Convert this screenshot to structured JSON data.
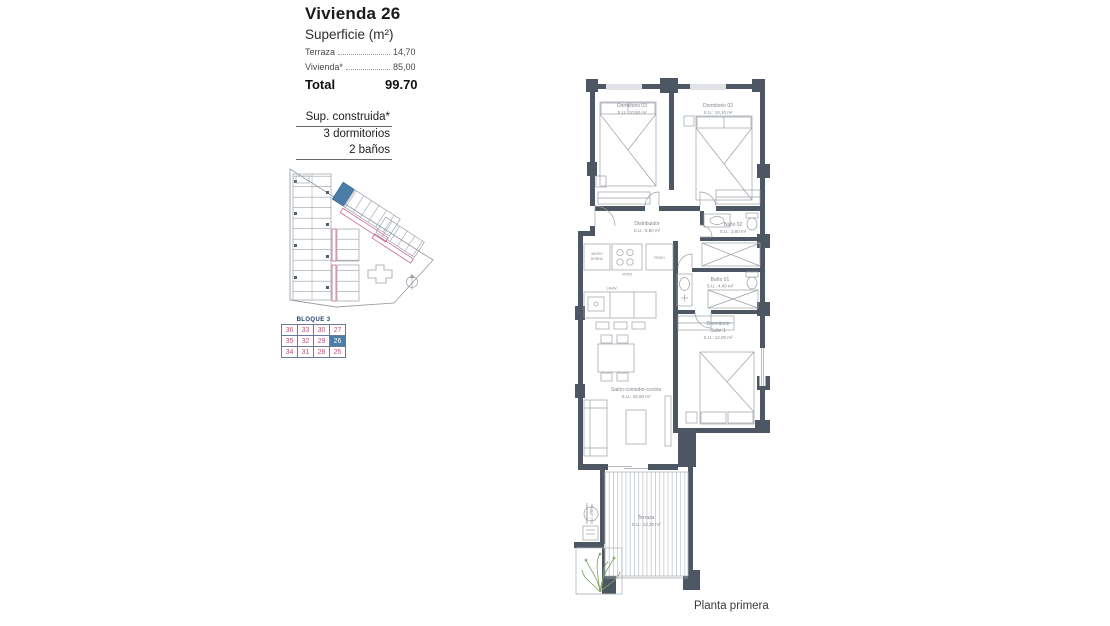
{
  "title_block": {
    "title": "Vivienda 26",
    "subtitle": "Superficie (m²)",
    "rows": [
      {
        "label": "Terraza",
        "value": "14,70"
      },
      {
        "label": "Vivienda*",
        "value": "85,00"
      }
    ],
    "total_label": "Total",
    "total_value": "99.70"
  },
  "summary": {
    "lines": [
      "Sup. construida*",
      "3 dormitorios",
      "2 baños"
    ]
  },
  "block_table": {
    "header": "BLOQUE 3",
    "rows": [
      [
        "36",
        "33",
        "30",
        "27"
      ],
      [
        "35",
        "32",
        "29",
        "26"
      ],
      [
        "34",
        "31",
        "28",
        "25"
      ]
    ],
    "highlighted_unit": "26",
    "number_color": "#c2537f",
    "highlight_color": "#4a7da8"
  },
  "site_plan": {
    "highlight_color": "#4a7da8",
    "outline_color": "#9aa0a8",
    "label_strip_color": "#c2537f"
  },
  "floor_plan": {
    "wall_color": "#4d5663",
    "line_color": "#8a9099",
    "text_color": "#80868f",
    "rooms": {
      "dorm3": {
        "name": "Dormitorio 03",
        "area": "S.U.: 10,50 m²"
      },
      "dorm2": {
        "name": "Dormitorio 02",
        "area": "S.U.: 10,10 m²"
      },
      "distribuidor": {
        "name": "Distribuidor",
        "area": "S.U.: 5,80 m²"
      },
      "bano2": {
        "name": "Baño 02",
        "area": "S.U.: 3,60 m²"
      },
      "bano1": {
        "name": "Baño 01",
        "area": "S.U.: 4,40 m²"
      },
      "suite": {
        "name_line1": "Dormitorio",
        "name_line2": "Suite 1",
        "area": "S.U.: 12,00 m²"
      },
      "salon": {
        "name": "Salón-comedor-cocina",
        "area": "S.U.: 25,50 m²"
      },
      "terraza": {
        "name": "Terraza",
        "area": "S.U.: 12,20 m²"
      },
      "instalaciones": {
        "name": "Instalaciones",
        "area": "S.U.: 2,50 m²"
      }
    },
    "fixtures": {
      "micro1": "MICRO",
      "micro2": "HORNO",
      "vitro": "VITRO",
      "frigo": "FRIGO",
      "lavav": "LAVAV."
    }
  },
  "footer": {
    "caption": "Planta primera"
  }
}
